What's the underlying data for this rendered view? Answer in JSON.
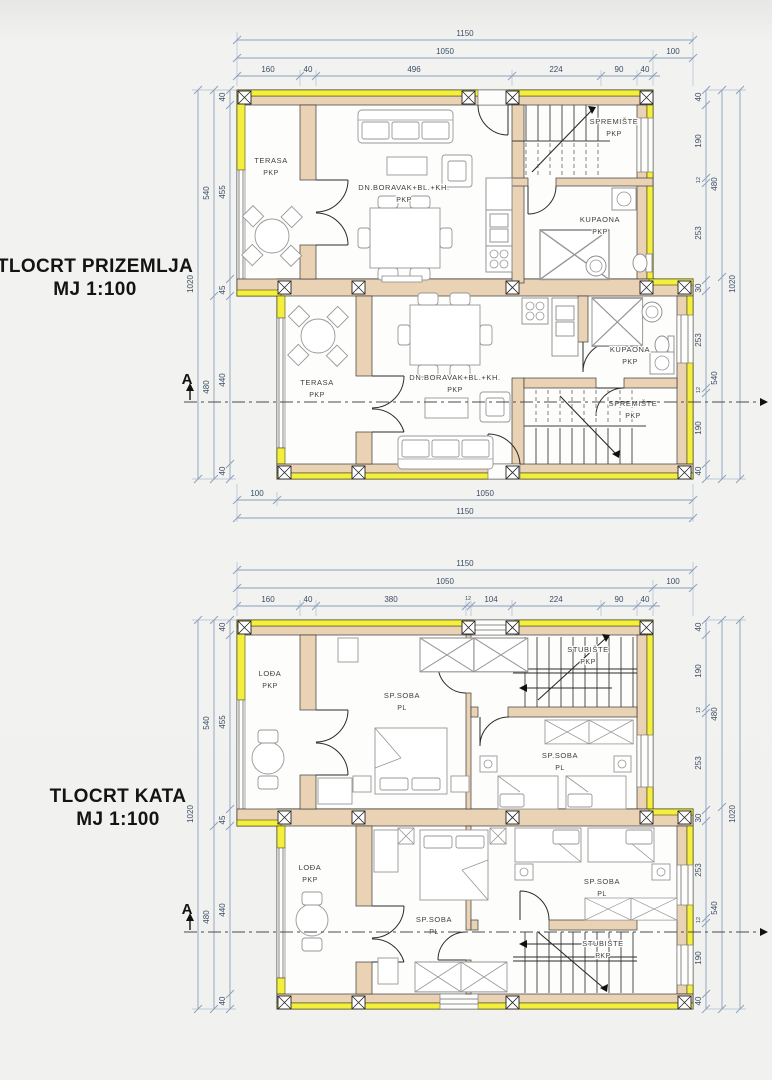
{
  "plan1": {
    "title": "TLOCRT PRIZEMLJA",
    "scale": "MJ 1:100",
    "section_label": "A",
    "dims": {
      "top_total": "1150",
      "top_main": "1050",
      "top_right_offset": "100",
      "top_detail": [
        "160",
        "40",
        "496",
        "224",
        "90",
        "40"
      ],
      "left_outer": "1020",
      "left_mid": [
        "540",
        "480"
      ],
      "left_detail": [
        "40",
        "455",
        "45",
        "440",
        "40"
      ],
      "right_outer": "1020",
      "right_mid": [
        "480",
        "540"
      ],
      "right_detail": [
        "40",
        "190",
        "12",
        "253",
        "30",
        "253",
        "12",
        "190",
        "40"
      ],
      "bottom_left_offset": "100",
      "bottom_main": "1050",
      "bottom_total": "1150"
    },
    "rooms": {
      "terasa": {
        "name": "TERASA",
        "type": "PKP"
      },
      "living": {
        "name": "DN.BORAVAK+BL.+KH.",
        "type": "PKP"
      },
      "spremiste": {
        "name": "SPREMIŠTE",
        "type": "PKP"
      },
      "kupaona": {
        "name": "KUPAONA",
        "type": "PKP"
      }
    }
  },
  "plan2": {
    "title": "TLOCRT KATA",
    "scale": "MJ 1:100",
    "section_label": "A",
    "dims": {
      "top_total": "1150",
      "top_main": "1050",
      "top_right_offset": "100",
      "top_detail": [
        "160",
        "40",
        "380",
        "12",
        "104",
        "224",
        "90",
        "40"
      ],
      "left_outer": "1020",
      "left_mid": [
        "540",
        "480"
      ],
      "left_detail": [
        "40",
        "455",
        "45",
        "440",
        "40"
      ],
      "right_outer": "1020",
      "right_mid": [
        "480",
        "540"
      ],
      "right_detail": [
        "40",
        "190",
        "12",
        "253",
        "30",
        "253",
        "12",
        "190",
        "40"
      ]
    },
    "rooms": {
      "lodja": {
        "name": "LOĐA",
        "type": "PKP"
      },
      "spsoba": {
        "name": "SP.SOBA",
        "type": "PL"
      },
      "stubiste": {
        "name": "STUBIŠTE",
        "type": "PKP"
      }
    }
  },
  "colors": {
    "wall": "#ead2b4",
    "insulation": "#f4ef3c",
    "dim_line": "#8aa0bc",
    "dim_text": "#3d4e66"
  }
}
